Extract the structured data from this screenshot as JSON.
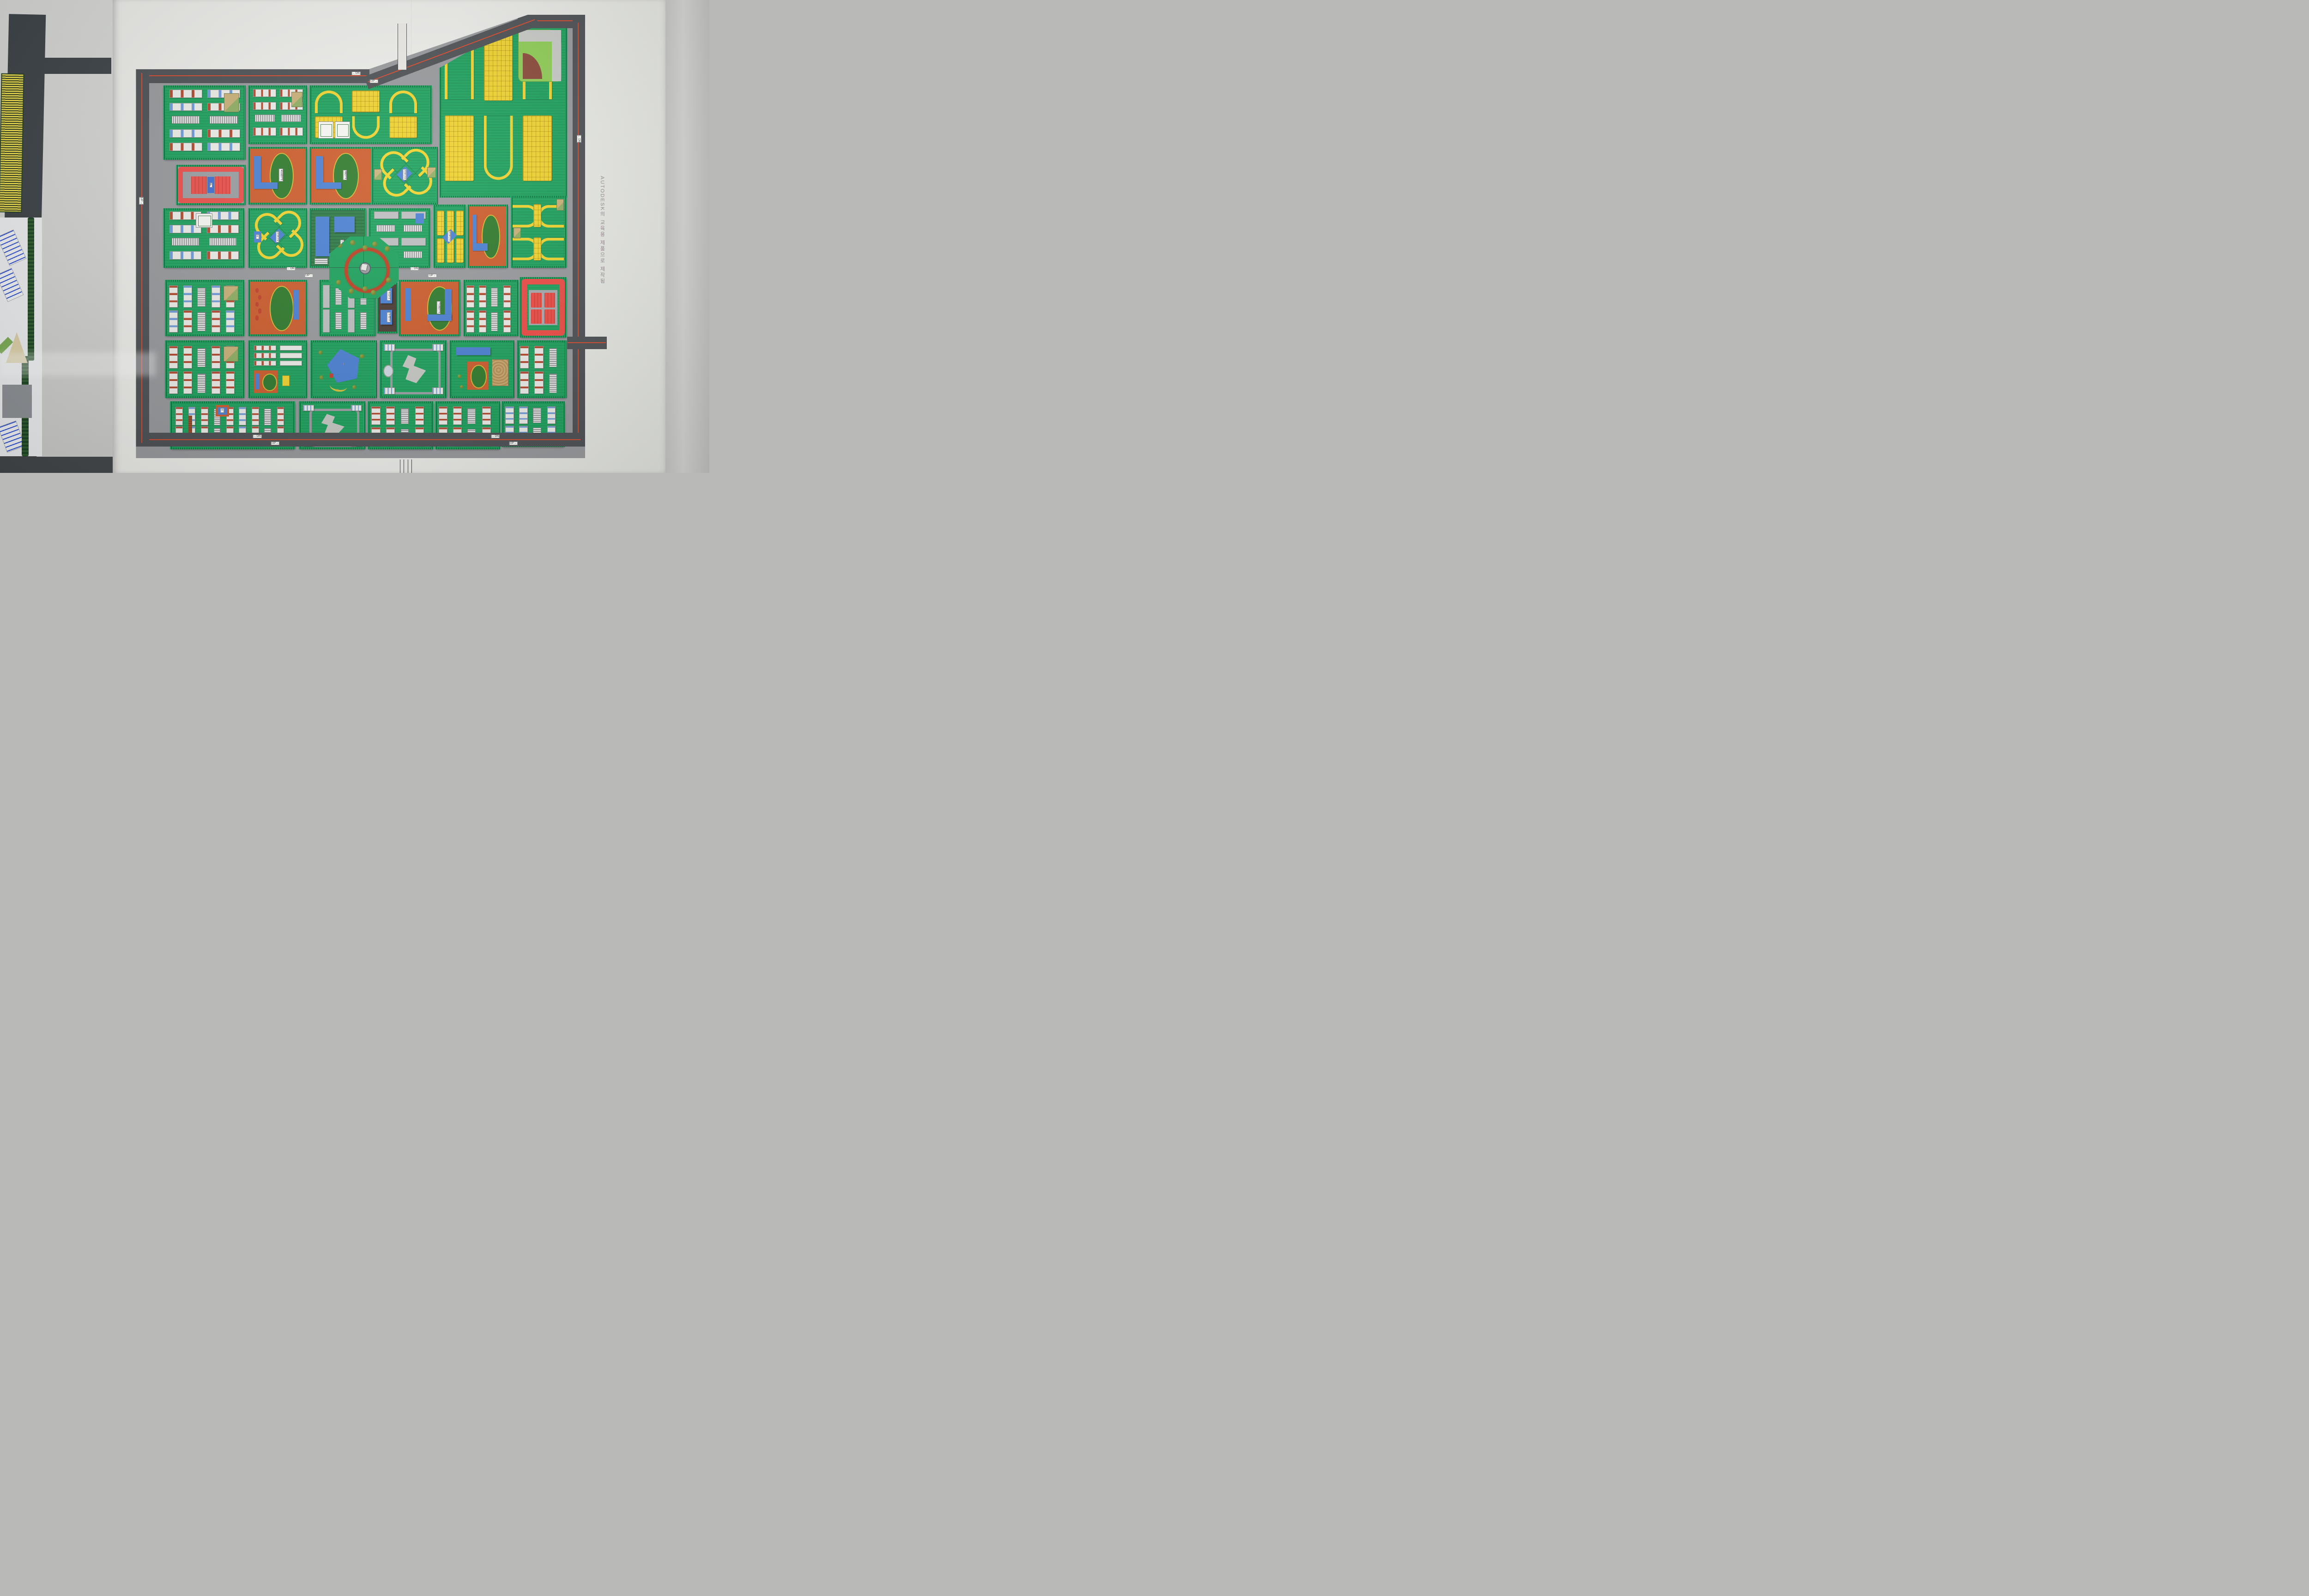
{
  "scene": {
    "description": "Photo of a Korean urban planning scale model poster"
  },
  "watermark": {
    "text": "AUTODESK의 교육용 제품으로 제작됨"
  },
  "labels": {
    "fire_station": "소방서",
    "post_office": "우체국",
    "high_school": "고등학교",
    "elementary_school": "초등학교",
    "middle_school": "중학교",
    "library": "도서관",
    "community": "커뮤니티",
    "parking": "P",
    "small_tag": "ㅇ"
  },
  "signs": {
    "up": "UP→",
    "dn": "←DN"
  },
  "palette": {
    "road_boundary": "#4d5054",
    "road_inner": "#97999c",
    "red_line": "#d7492c",
    "block_green": "#1da35d",
    "hedge_dark": "#0a6b38",
    "rowhouse_yellow": "#f0d42e",
    "building_white": "#ecece8",
    "accent_red": "#b34a2e",
    "accent_blue": "#6c9bd8",
    "civic_blue": "#4b80d3",
    "commercial_red": "#ea4f4a",
    "school_orange": "#cd5c2c",
    "track_green": "#2f7a2c",
    "track_rim_yellow": "#d8b835",
    "poster_white": "#ecede9"
  },
  "model": {
    "blocks": [
      {
        "id": "nw-apartments",
        "type": "apt",
        "x": 6,
        "y": 16,
        "w": 17.6,
        "h": 15.9,
        "dir": "h",
        "accent": "mixed",
        "parks": true
      },
      {
        "id": "n-apartments",
        "type": "apt",
        "x": 24.9,
        "y": 16,
        "w": 12.4,
        "h": 12.3,
        "dir": "h",
        "accent": "red",
        "parks": true
      },
      {
        "id": "n-rowhouse-estate",
        "type": "estate",
        "x": 38.6,
        "y": 16,
        "w": 26.4,
        "h": 12.3,
        "courts": true
      },
      {
        "id": "ne-rowhouse-estate",
        "type": "estate",
        "x": 67.5,
        "y": 1.8,
        "w": 27.7,
        "h": 38.6,
        "baseball": true,
        "clip": "polygon(0% 26%,62% 0%,100% 0%,100% 100%,0% 100%)"
      },
      {
        "id": "red-market-block",
        "type": "redp",
        "x": 8.9,
        "y": 33.9,
        "w": 14.7,
        "h": 8.2,
        "label": "parking"
      },
      {
        "id": "elementary-school",
        "type": "school",
        "x": 24.9,
        "y": 29.8,
        "w": 12.4,
        "h": 12.2,
        "label": "elementary_school"
      },
      {
        "id": "middle-school",
        "type": "school",
        "x": 38.6,
        "y": 29.8,
        "w": 13.4,
        "h": 12.2,
        "label": "middle_school"
      },
      {
        "id": "x-cluster-north",
        "type": "xcluster",
        "x": 52.4,
        "y": 29.8,
        "w": 14,
        "h": 12.2,
        "label": "community",
        "parks": true
      },
      {
        "id": "w-apartments",
        "type": "apt",
        "x": 6,
        "y": 43.6,
        "w": 17.3,
        "h": 12.7,
        "dir": "h",
        "accent": "mixed",
        "court": true
      },
      {
        "id": "x-cluster-west",
        "type": "xcluster",
        "x": 24.9,
        "y": 43.6,
        "w": 12.4,
        "h": 12.7,
        "label": "community",
        "tag": true
      },
      {
        "id": "library-block",
        "type": "library",
        "x": 38.6,
        "y": 43.6,
        "w": 11.8,
        "h": 12.7,
        "label": "library"
      },
      {
        "id": "central-gray-rows",
        "type": "grayrows",
        "x": 51.8,
        "y": 43.6,
        "w": 12.9,
        "h": 12.7,
        "dir": "h"
      },
      {
        "id": "bar-rowhouses",
        "type": "barrows",
        "x": 66.2,
        "y": 42.8,
        "w": 6.4,
        "h": 13.5,
        "label": "community"
      },
      {
        "id": "school-east",
        "type": "school",
        "x": 73.8,
        "y": 42.8,
        "w": 8.2,
        "h": 13.5,
        "mini": true
      },
      {
        "id": "e-rowhouses",
        "type": "hairpinrows",
        "x": 83.4,
        "y": 40.8,
        "w": 11.6,
        "h": 15.5
      },
      {
        "id": "w-apartments-2",
        "type": "apt",
        "x": 6.4,
        "y": 59.8,
        "w": 16.9,
        "h": 11.9,
        "dir": "v",
        "accent": "mixed",
        "parks": true
      },
      {
        "id": "school-track-west",
        "type": "school",
        "x": 24.9,
        "y": 59.8,
        "w": 12.4,
        "h": 11.9,
        "snake": true
      },
      {
        "id": "central-gray-rows-2",
        "type": "grayrows",
        "x": 40.8,
        "y": 59.8,
        "w": 11.8,
        "h": 11.9,
        "dir": "v"
      },
      {
        "id": "civic-strip",
        "type": "civic",
        "x": 53.6,
        "y": 60.4,
        "w": 3.9,
        "h": 10.6,
        "labels": [
          "fire_station",
          "post_office"
        ]
      },
      {
        "id": "high-school",
        "type": "school",
        "x": 58.4,
        "y": 59.8,
        "w": 13,
        "h": 11.9,
        "label": "high_school",
        "flip": true
      },
      {
        "id": "e-apartments",
        "type": "apt",
        "x": 72.8,
        "y": 59.8,
        "w": 11.6,
        "h": 11.9,
        "dir": "v",
        "accent": "red"
      },
      {
        "id": "red-commercial-center",
        "type": "red4",
        "x": 85.4,
        "y": 59.2,
        "w": 9.6,
        "h": 12.8
      },
      {
        "id": "sw-apartments",
        "type": "apt",
        "x": 6.4,
        "y": 73.4,
        "w": 16.9,
        "h": 12.2,
        "dir": "v",
        "accent": "red",
        "parks": true
      },
      {
        "id": "kindergarten-block",
        "type": "kinder",
        "x": 24.9,
        "y": 73.4,
        "w": 12.4,
        "h": 12.2
      },
      {
        "id": "pentagon-park",
        "type": "pent",
        "x": 38.8,
        "y": 73.4,
        "w": 14,
        "h": 12.2
      },
      {
        "id": "plaza-hall",
        "type": "hall",
        "x": 54.2,
        "y": 73.4,
        "w": 14.2,
        "h": 12.2,
        "plaza": true
      },
      {
        "id": "sports-block",
        "type": "sports",
        "x": 69.8,
        "y": 73.4,
        "w": 13.6,
        "h": 12.2
      },
      {
        "id": "se-apartments",
        "type": "apt",
        "x": 84.8,
        "y": 73.4,
        "w": 10.2,
        "h": 12.2,
        "dir": "v",
        "accent": "red"
      },
      {
        "id": "s-apartments-wide",
        "type": "aptwide",
        "x": 7.6,
        "y": 87.2,
        "w": 27,
        "h": 10,
        "tag": "small_tag"
      },
      {
        "id": "hall-south",
        "type": "hall",
        "x": 36.2,
        "y": 87.2,
        "w": 14,
        "h": 10
      },
      {
        "id": "s-apartments-2",
        "type": "apt",
        "x": 51.6,
        "y": 87.2,
        "w": 13.8,
        "h": 10,
        "dir": "v",
        "accent": "red"
      },
      {
        "id": "s-apartments-3",
        "type": "apt",
        "x": 66.6,
        "y": 87.2,
        "w": 13.6,
        "h": 10,
        "dir": "v",
        "accent": "red"
      },
      {
        "id": "s-apartments-4",
        "type": "apt",
        "x": 81.4,
        "y": 87.2,
        "w": 13.2,
        "h": 9.4,
        "dir": "v",
        "accent": "blue"
      }
    ],
    "boundary_roads": [
      {
        "id": "road-top-left",
        "x": 0,
        "y": 12.3,
        "w": 52,
        "h": 3.1,
        "red": "h"
      },
      {
        "id": "road-top-right",
        "x": 85,
        "y": 0,
        "w": 15,
        "h": 3.0,
        "red": "h"
      },
      {
        "id": "road-right",
        "x": 97.2,
        "y": 0.8,
        "w": 2.8,
        "h": 96.5,
        "red": "v"
      },
      {
        "id": "road-bottom",
        "x": 0,
        "y": 94.3,
        "w": 100,
        "h": 3.1,
        "red": "h"
      },
      {
        "id": "road-left",
        "x": 0,
        "y": 12.3,
        "w": 2.9,
        "h": 85.1,
        "red": "v"
      }
    ],
    "diagonal_road": {
      "x": 51.3,
      "y": 13.9,
      "w": 40.5,
      "h": 3.0,
      "angle": -20.5
    },
    "roundabout": {
      "x": 43,
      "y": 50,
      "w": 15.5,
      "h": 14
    },
    "sign_positions": [
      {
        "x": 49,
        "y": 13.2,
        "k": "dn"
      },
      {
        "x": 53,
        "y": 15.0,
        "k": "up"
      },
      {
        "x": 34.5,
        "y": 57.3,
        "k": "dn"
      },
      {
        "x": 38.5,
        "y": 58.8,
        "k": "up"
      },
      {
        "x": 62,
        "y": 57.3,
        "k": "dn"
      },
      {
        "x": 66,
        "y": 58.8,
        "k": "up"
      },
      {
        "x": 27,
        "y": 95.1,
        "k": "dn"
      },
      {
        "x": 31,
        "y": 96.6,
        "k": "up"
      },
      {
        "x": 80,
        "y": 95.1,
        "k": "dn"
      },
      {
        "x": 84,
        "y": 96.6,
        "k": "up"
      },
      {
        "x": 98.6,
        "y": 28,
        "k": "dn",
        "v": 1
      },
      {
        "x": 1.2,
        "y": 42,
        "k": "up",
        "v": 1
      }
    ]
  }
}
